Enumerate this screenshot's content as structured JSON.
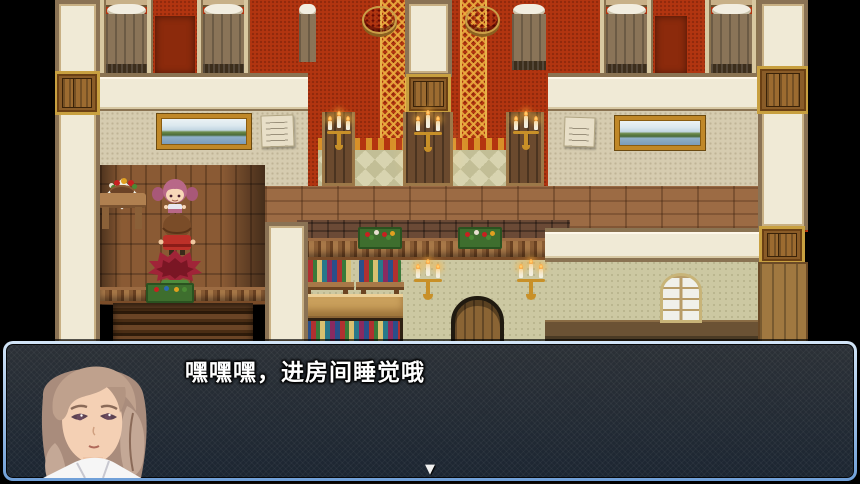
{
  "window": {
    "width": 860,
    "height": 484
  },
  "dialogue_box": {
    "text": "嘿嘿嘿，进房间睡觉哦",
    "continue_indicator": "▼",
    "portrait": "young-woman-light-brown-braided-hair",
    "border_color": "#9fc0e8",
    "background_color": "rgba(12,14,18,0.84)",
    "text_color": "#ffffff"
  },
  "scene": {
    "location": "inn-interior-two-floors",
    "characters": [
      {
        "name": "pink-haired-girl",
        "facing": "down"
      },
      {
        "name": "brown-haired-child-red-cape",
        "facing": "up"
      },
      {
        "name": "red-spiky-haired-child-green-outfit",
        "facing": "up"
      }
    ],
    "props": [
      "flower-basket-table",
      "round-red-tables",
      "curtained-alcoves",
      "candelabra-pillars",
      "landscape-paintings",
      "wall-notes",
      "balustrade-flower-boxes",
      "wall-bookshelves",
      "wall-sconces",
      "arched-door",
      "arched-windows",
      "staircase"
    ],
    "colors": {
      "void": "#000000",
      "red_wall": "#b23510",
      "carpet_trim_gold": "#d89028",
      "cream_panel": "#f0ead6",
      "wood_floor": "#9c6b44",
      "lower_wallpaper": "#ccc8a2"
    }
  }
}
